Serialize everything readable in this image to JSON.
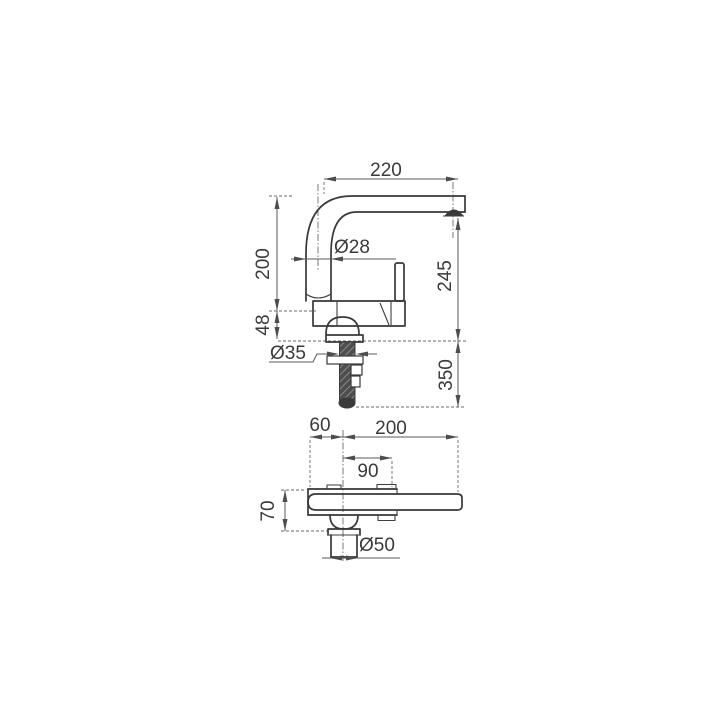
{
  "drawing": {
    "front_view": {
      "spout_reach": "220",
      "spout_height": "200",
      "body_height": "48",
      "spout_tube_diameter": "Ø28",
      "outlet_height": "245",
      "under_counter_length": "350",
      "mounting_hole_diameter": "Ø35"
    },
    "plan_view": {
      "handle_offset": "60",
      "spout_projection": "200",
      "handle_length": "90",
      "body_width": "70",
      "base_diameter": "Ø50"
    },
    "colors": {
      "object_line": "#383838",
      "dimension_line": "#5a5a5a",
      "label_text": "#3a3a3a",
      "background": "#ffffff"
    }
  }
}
